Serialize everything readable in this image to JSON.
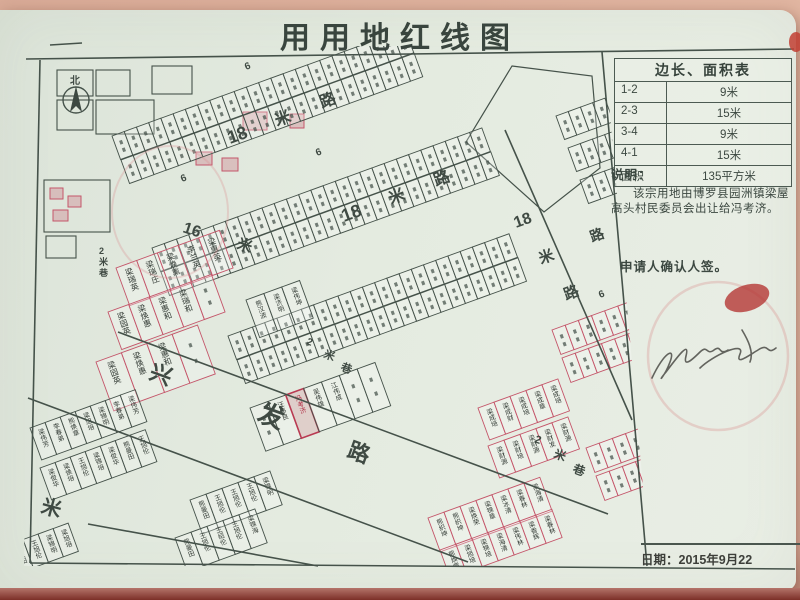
{
  "document": {
    "title": "用用地红线图",
    "note_label": "说明：",
    "note_body": "该宗用地由博罗县园洲镇梁屋高头村民委员会出让给冯考济。",
    "applicant_line": "申请人确认人签。",
    "date": "日期：2015年9月22",
    "compass_label": "北"
  },
  "dimension_table": {
    "header": "边长、面积表",
    "rows": [
      {
        "side": "1-2",
        "value": "9米"
      },
      {
        "side": "2-3",
        "value": "15米"
      },
      {
        "side": "3-4",
        "value": "9米"
      },
      {
        "side": "4-1",
        "value": "15米"
      },
      {
        "side": "面积",
        "value": "135平方米"
      }
    ]
  },
  "colors": {
    "ink": "#45524a",
    "red_line": "#c4566a",
    "seal_red": "#b33331",
    "subject_fill": "rgba(199,62,84,0.16)",
    "paper": "#e4ebe0"
  },
  "map": {
    "clip": "30,46 604,46 650,566 24,566",
    "frame_lines": [
      [
        26,
        59,
        794,
        49
      ],
      [
        40,
        60,
        30,
        563
      ],
      [
        30,
        563,
        795,
        569
      ],
      [
        602,
        52,
        647,
        566
      ],
      [
        118,
        332,
        608,
        514
      ],
      [
        28,
        398,
        468,
        562
      ],
      [
        88,
        524,
        318,
        566
      ],
      [
        505,
        130,
        632,
        420
      ],
      [
        50,
        45,
        82,
        43
      ]
    ],
    "polygons": [
      {
        "points": "512,66 592,76 600,168 544,212 466,142"
      }
    ],
    "rects": [
      {
        "x": 57,
        "y": 70,
        "w": 36,
        "h": 26
      },
      {
        "x": 96,
        "y": 70,
        "w": 34,
        "h": 26
      },
      {
        "x": 57,
        "y": 100,
        "w": 36,
        "h": 30
      },
      {
        "x": 96,
        "y": 100,
        "w": 58,
        "h": 34
      },
      {
        "x": 152,
        "y": 66,
        "w": 40,
        "h": 28
      },
      {
        "x": 44,
        "y": 180,
        "w": 66,
        "h": 52
      },
      {
        "x": 46,
        "y": 236,
        "w": 30,
        "h": 22
      },
      {
        "x": 243,
        "y": 112,
        "w": 24,
        "h": 18,
        "red": 1
      },
      {
        "x": 290,
        "y": 114,
        "w": 14,
        "h": 14,
        "red": 1
      },
      {
        "x": 50,
        "y": 188,
        "w": 13,
        "h": 11,
        "red": 1
      },
      {
        "x": 68,
        "y": 196,
        "w": 13,
        "h": 11,
        "red": 1
      },
      {
        "x": 53,
        "y": 210,
        "w": 15,
        "h": 11,
        "red": 1
      },
      {
        "x": 196,
        "y": 152,
        "w": 16,
        "h": 13,
        "red": 1
      },
      {
        "x": 222,
        "y": 158,
        "w": 16,
        "h": 13,
        "red": 1
      }
    ],
    "road_labels": [
      {
        "t": "18",
        "x": 230,
        "y": 144,
        "s": 18,
        "r": -20
      },
      {
        "t": "米",
        "x": 277,
        "y": 126,
        "s": 16,
        "r": -20
      },
      {
        "t": "路",
        "x": 322,
        "y": 108,
        "s": 16,
        "r": -20
      },
      {
        "t": "18",
        "x": 344,
        "y": 222,
        "s": 18,
        "r": -20
      },
      {
        "t": "米",
        "x": 391,
        "y": 204,
        "s": 16,
        "r": -20
      },
      {
        "t": "路",
        "x": 436,
        "y": 186,
        "s": 16,
        "r": -20
      },
      {
        "t": "18",
        "x": 516,
        "y": 228,
        "s": 16,
        "r": -20
      },
      {
        "t": "米",
        "x": 541,
        "y": 264,
        "s": 15,
        "r": -20
      },
      {
        "t": "路",
        "x": 566,
        "y": 300,
        "s": 15,
        "r": -20
      },
      {
        "t": "路",
        "x": 592,
        "y": 242,
        "s": 14,
        "r": -20
      },
      {
        "t": "16",
        "x": 182,
        "y": 232,
        "s": 16,
        "r": 18
      },
      {
        "t": "米",
        "x": 236,
        "y": 248,
        "s": 15,
        "r": 18
      },
      {
        "t": "兴",
        "x": 148,
        "y": 378,
        "s": 22,
        "r": 20
      },
      {
        "t": "发",
        "x": 256,
        "y": 420,
        "s": 26,
        "r": 20
      },
      {
        "t": "路",
        "x": 346,
        "y": 456,
        "s": 22,
        "r": 20
      },
      {
        "t": "米",
        "x": 40,
        "y": 512,
        "s": 20,
        "r": 15
      },
      {
        "t": "米",
        "x": 8,
        "y": 284,
        "s": 13,
        "r": 0
      },
      {
        "t": "2",
        "x": 306,
        "y": 344,
        "s": 10,
        "r": 20
      },
      {
        "t": "米",
        "x": 323,
        "y": 357,
        "s": 11,
        "r": 20
      },
      {
        "t": "巷",
        "x": 340,
        "y": 370,
        "s": 11,
        "r": 20
      },
      {
        "t": "2",
        "x": 99,
        "y": 254,
        "s": 9,
        "r": 0
      },
      {
        "t": "米",
        "x": 99,
        "y": 265,
        "s": 9,
        "r": 0
      },
      {
        "t": "巷",
        "x": 99,
        "y": 276,
        "s": 9,
        "r": 0
      },
      {
        "t": "2",
        "x": 534,
        "y": 442,
        "s": 11,
        "r": 20
      },
      {
        "t": "米",
        "x": 553,
        "y": 457,
        "s": 12,
        "r": 20
      },
      {
        "t": "巷",
        "x": 572,
        "y": 472,
        "s": 12,
        "r": 20
      },
      {
        "t": "6",
        "x": 246,
        "y": 70,
        "s": 10,
        "r": -20
      },
      {
        "t": "6",
        "x": 182,
        "y": 182,
        "s": 10,
        "r": -20
      },
      {
        "t": "6",
        "x": 317,
        "y": 156,
        "s": 10,
        "r": -20
      },
      {
        "t": "6",
        "x": 600,
        "y": 298,
        "s": 10,
        "r": -20
      },
      {
        "t": "北",
        "x": 70,
        "y": 84,
        "s": 10,
        "r": 0
      }
    ],
    "strips": [
      {
        "x": 112,
        "y": 136,
        "n": 24,
        "cw": 13,
        "ch": 25,
        "rot": -20
      },
      {
        "x": 121,
        "y": 160,
        "n": 24,
        "cw": 13,
        "ch": 25,
        "rot": -20
      },
      {
        "x": 152,
        "y": 248,
        "n": 27,
        "cw": 13,
        "ch": 25,
        "rot": -20
      },
      {
        "x": 161,
        "y": 272,
        "n": 27,
        "cw": 13,
        "ch": 25,
        "rot": -20
      },
      {
        "x": 228,
        "y": 336,
        "n": 23,
        "cw": 13,
        "ch": 25,
        "rot": -20
      },
      {
        "x": 237,
        "y": 360,
        "n": 23,
        "cw": 13,
        "ch": 25,
        "rot": -20
      },
      {
        "x": 556,
        "y": 116,
        "n": 4,
        "cw": 13,
        "ch": 25,
        "rot": -20
      },
      {
        "x": 568,
        "y": 148,
        "n": 4,
        "cw": 13,
        "ch": 25,
        "rot": -20
      },
      {
        "x": 580,
        "y": 180,
        "n": 4,
        "cw": 13,
        "ch": 25,
        "rot": -20
      },
      {
        "x": 552,
        "y": 330,
        "n": 6,
        "cw": 14,
        "ch": 26,
        "rot": -20,
        "red": true
      },
      {
        "x": 562,
        "y": 358,
        "n": 6,
        "cw": 14,
        "ch": 26,
        "rot": -20,
        "red": true
      },
      {
        "x": 586,
        "y": 448,
        "n": 4,
        "cw": 14,
        "ch": 26,
        "rot": -20,
        "red": true
      },
      {
        "x": 596,
        "y": 476,
        "n": 4,
        "cw": 14,
        "ch": 26,
        "rot": -20,
        "red": true
      },
      {
        "x": 116,
        "y": 268,
        "n": 5,
        "cw": 22,
        "ch": 40,
        "rot": -20,
        "red": true,
        "names": [
          "梁瑞英",
          "梁瑞庄",
          "梁焕熏",
          "李兰英",
          "梁惠英"
        ]
      },
      {
        "x": 108,
        "y": 312,
        "n": 5,
        "cw": 22,
        "ch": 40,
        "rot": -20,
        "red": true,
        "names": [
          "梁园英",
          "梁焕惠",
          "梁惠和",
          "梁瑞和",
          ""
        ]
      },
      {
        "x": 96,
        "y": 362,
        "n": 4,
        "cw": 27,
        "ch": 52,
        "rot": -20,
        "red": true,
        "names": [
          "梁园英",
          "梁焕惠",
          "梁惠和",
          ""
        ]
      },
      {
        "x": 246,
        "y": 300,
        "n": 3,
        "cw": 19,
        "ch": 40,
        "rot": -20,
        "names": [
          "熊汉波",
          "梁济明",
          "梁伟坤"
        ]
      },
      {
        "x": 250,
        "y": 408,
        "n": 7,
        "cw": 19,
        "ch": 46,
        "rot": -20,
        "subject_index": 2,
        "names": [
          "",
          "汪伟良",
          "冯考济",
          "吴伟雄",
          "江伟成",
          "",
          ""
        ]
      },
      {
        "x": 478,
        "y": 408,
        "n": 5,
        "cw": 17,
        "ch": 34,
        "rot": -20,
        "red": true,
        "names": [
          "梁成培",
          "梁成财",
          "梁成培",
          "梁成章",
          "梁成培"
        ]
      },
      {
        "x": 488,
        "y": 446,
        "n": 5,
        "cw": 17,
        "ch": 34,
        "rot": -20,
        "red": true,
        "names": [
          "梁财源",
          "梁财培",
          "梁财源",
          "梁财发",
          "梁财源"
        ]
      },
      {
        "x": 428,
        "y": 518,
        "n": 7,
        "cw": 17,
        "ch": 36,
        "rot": -20,
        "red": true,
        "names": [
          "熊织坤",
          "熊织坤",
          "梁焕荣",
          "梁锦章",
          "梁冰清",
          "梁春林",
          "梁海清"
        ]
      },
      {
        "x": 440,
        "y": 550,
        "n": 7,
        "cw": 17,
        "ch": 30,
        "rot": -20,
        "red": true,
        "names": [
          "熊焕章",
          "梁旭培",
          "梁锦培",
          "梁海清",
          "梁伟林",
          "梁香辉",
          "梁春林"
        ]
      },
      {
        "x": 30,
        "y": 428,
        "n": 7,
        "cw": 16,
        "ch": 34,
        "rot": -20,
        "names": [
          "梁伟芳",
          "李春弟",
          "熊焕章",
          "梁旭培",
          "梁锦明",
          "李春弟",
          "梁伟芳"
        ]
      },
      {
        "x": 40,
        "y": 468,
        "n": 7,
        "cw": 16,
        "ch": 34,
        "rot": -20,
        "names": [
          "梁俊华",
          "梁焕培",
          "王旭伦",
          "梁锦培",
          "梁俊华",
          "熊曼田",
          "王旭伦"
        ]
      },
      {
        "x": 190,
        "y": 500,
        "n": 5,
        "cw": 17,
        "ch": 36,
        "rot": -20,
        "names": [
          "熊曼田",
          "王旭伦",
          "王旭伦",
          "王旭伦",
          "梁锦明"
        ]
      },
      {
        "x": 175,
        "y": 538,
        "n": 5,
        "cw": 17,
        "ch": 36,
        "rot": -20,
        "names": [
          "熊曼田",
          "王旭伦",
          "王绍伦",
          "王旭伦",
          "梁锦海"
        ]
      },
      {
        "x": 8,
        "y": 545,
        "n": 4,
        "cw": 16,
        "ch": 30,
        "rot": -20,
        "names": [
          "熊曼田",
          "王旭伦",
          "梁锦明",
          "梁旭培"
        ]
      }
    ],
    "compass": {
      "cx": 76,
      "cy": 100,
      "r": 13
    },
    "seals": [
      {
        "type": "ring",
        "cx": 170,
        "cy": 212,
        "rx": 58,
        "ry": 66,
        "stroke": "#d98f93",
        "op": 0.3,
        "w": 2
      },
      {
        "type": "ring",
        "cx": 718,
        "cy": 356,
        "rx": 70,
        "ry": 74,
        "stroke": "#d87f7c",
        "op": 0.28,
        "w": 2.5
      },
      {
        "type": "blob",
        "cx": 747,
        "cy": 298,
        "rx": 23,
        "ry": 13,
        "rot": -18,
        "fill": "#b33331",
        "op": 0.78
      },
      {
        "type": "blob",
        "cx": 796,
        "cy": 42,
        "rx": 7,
        "ry": 10,
        "rot": 0,
        "fill": "#c24034",
        "op": 0.85
      }
    ],
    "signature_path": "M652,378 C664,352 676,346 670,362 C664,378 656,384 666,372 C678,356 690,340 686,356 C683,368 692,360 700,352 C708,344 706,356 714,350 C722,344 718,356 728,350 M700,368 C712,356 746,340 740,354 C735,366 748,356 758,350 C770,342 766,356 776,348 M742,330 C748,340 754,352 750,362"
  }
}
